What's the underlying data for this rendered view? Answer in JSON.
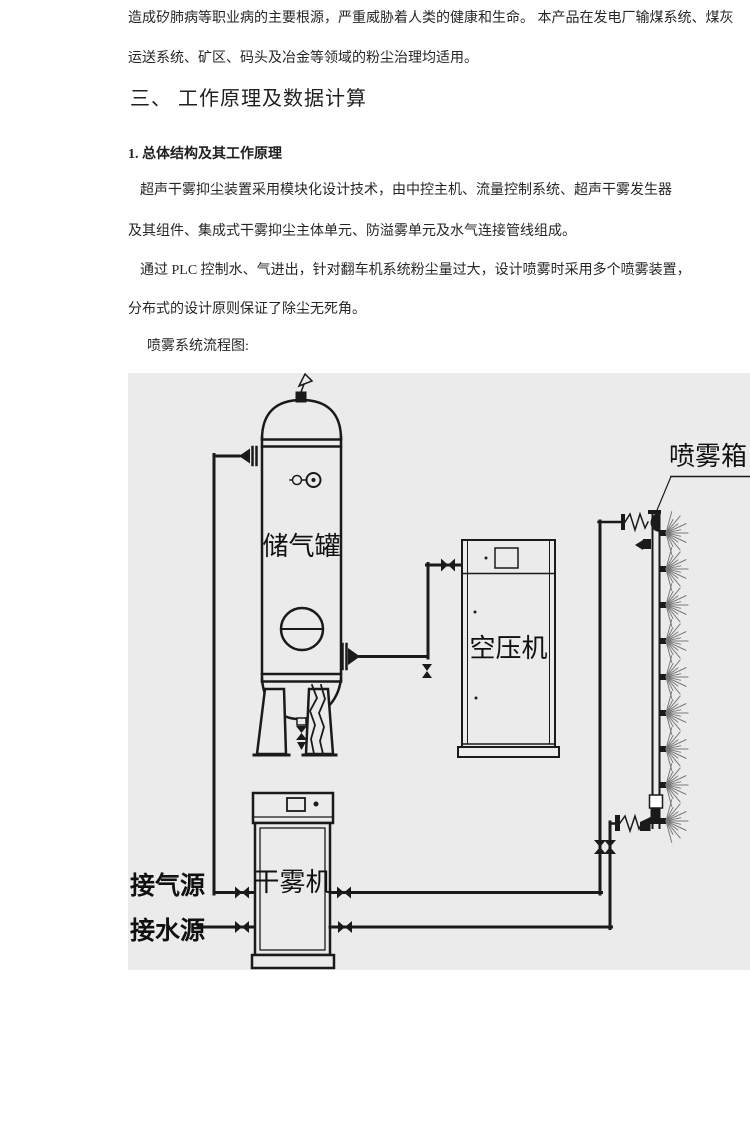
{
  "document": {
    "intro": [
      "造成矽肺病等职业病的主要根源，严重威胁着人类的健康和生命。 本产品在发电厂输煤系统、煤灰",
      "运送系统、矿区、码头及冶金等领域的粉尘治理均适用。"
    ],
    "section_heading": "三、 工作原理及数据计算",
    "subsection_heading": "1. 总体结构及其工作原理",
    "paragraph1": [
      "超声干雾抑尘装置采用模块化设计技术，由中控主机、流量控制系统、超声干雾发生器",
      "及其组件、集成式干雾抑尘主体单元、防溢雾单元及水气连接管线组成。"
    ],
    "paragraph2": [
      "通过 PLC 控制水、气进出，针对翻车机系统粉尘量过大，设计喷雾时采用多个喷雾装置，",
      "分布式的设计原则保证了除尘无死角。"
    ],
    "figure_caption": "喷雾系统流程图:"
  },
  "diagram": {
    "labels": {
      "tank": "储气罐",
      "compressor": "空压机",
      "fog_machine": "干雾机",
      "spray_box": "喷雾箱",
      "gas_source": "接气源",
      "water_source": "接水源"
    },
    "colors": {
      "panel_bg": "#ebebeb",
      "line": "#1a1a1a"
    }
  }
}
